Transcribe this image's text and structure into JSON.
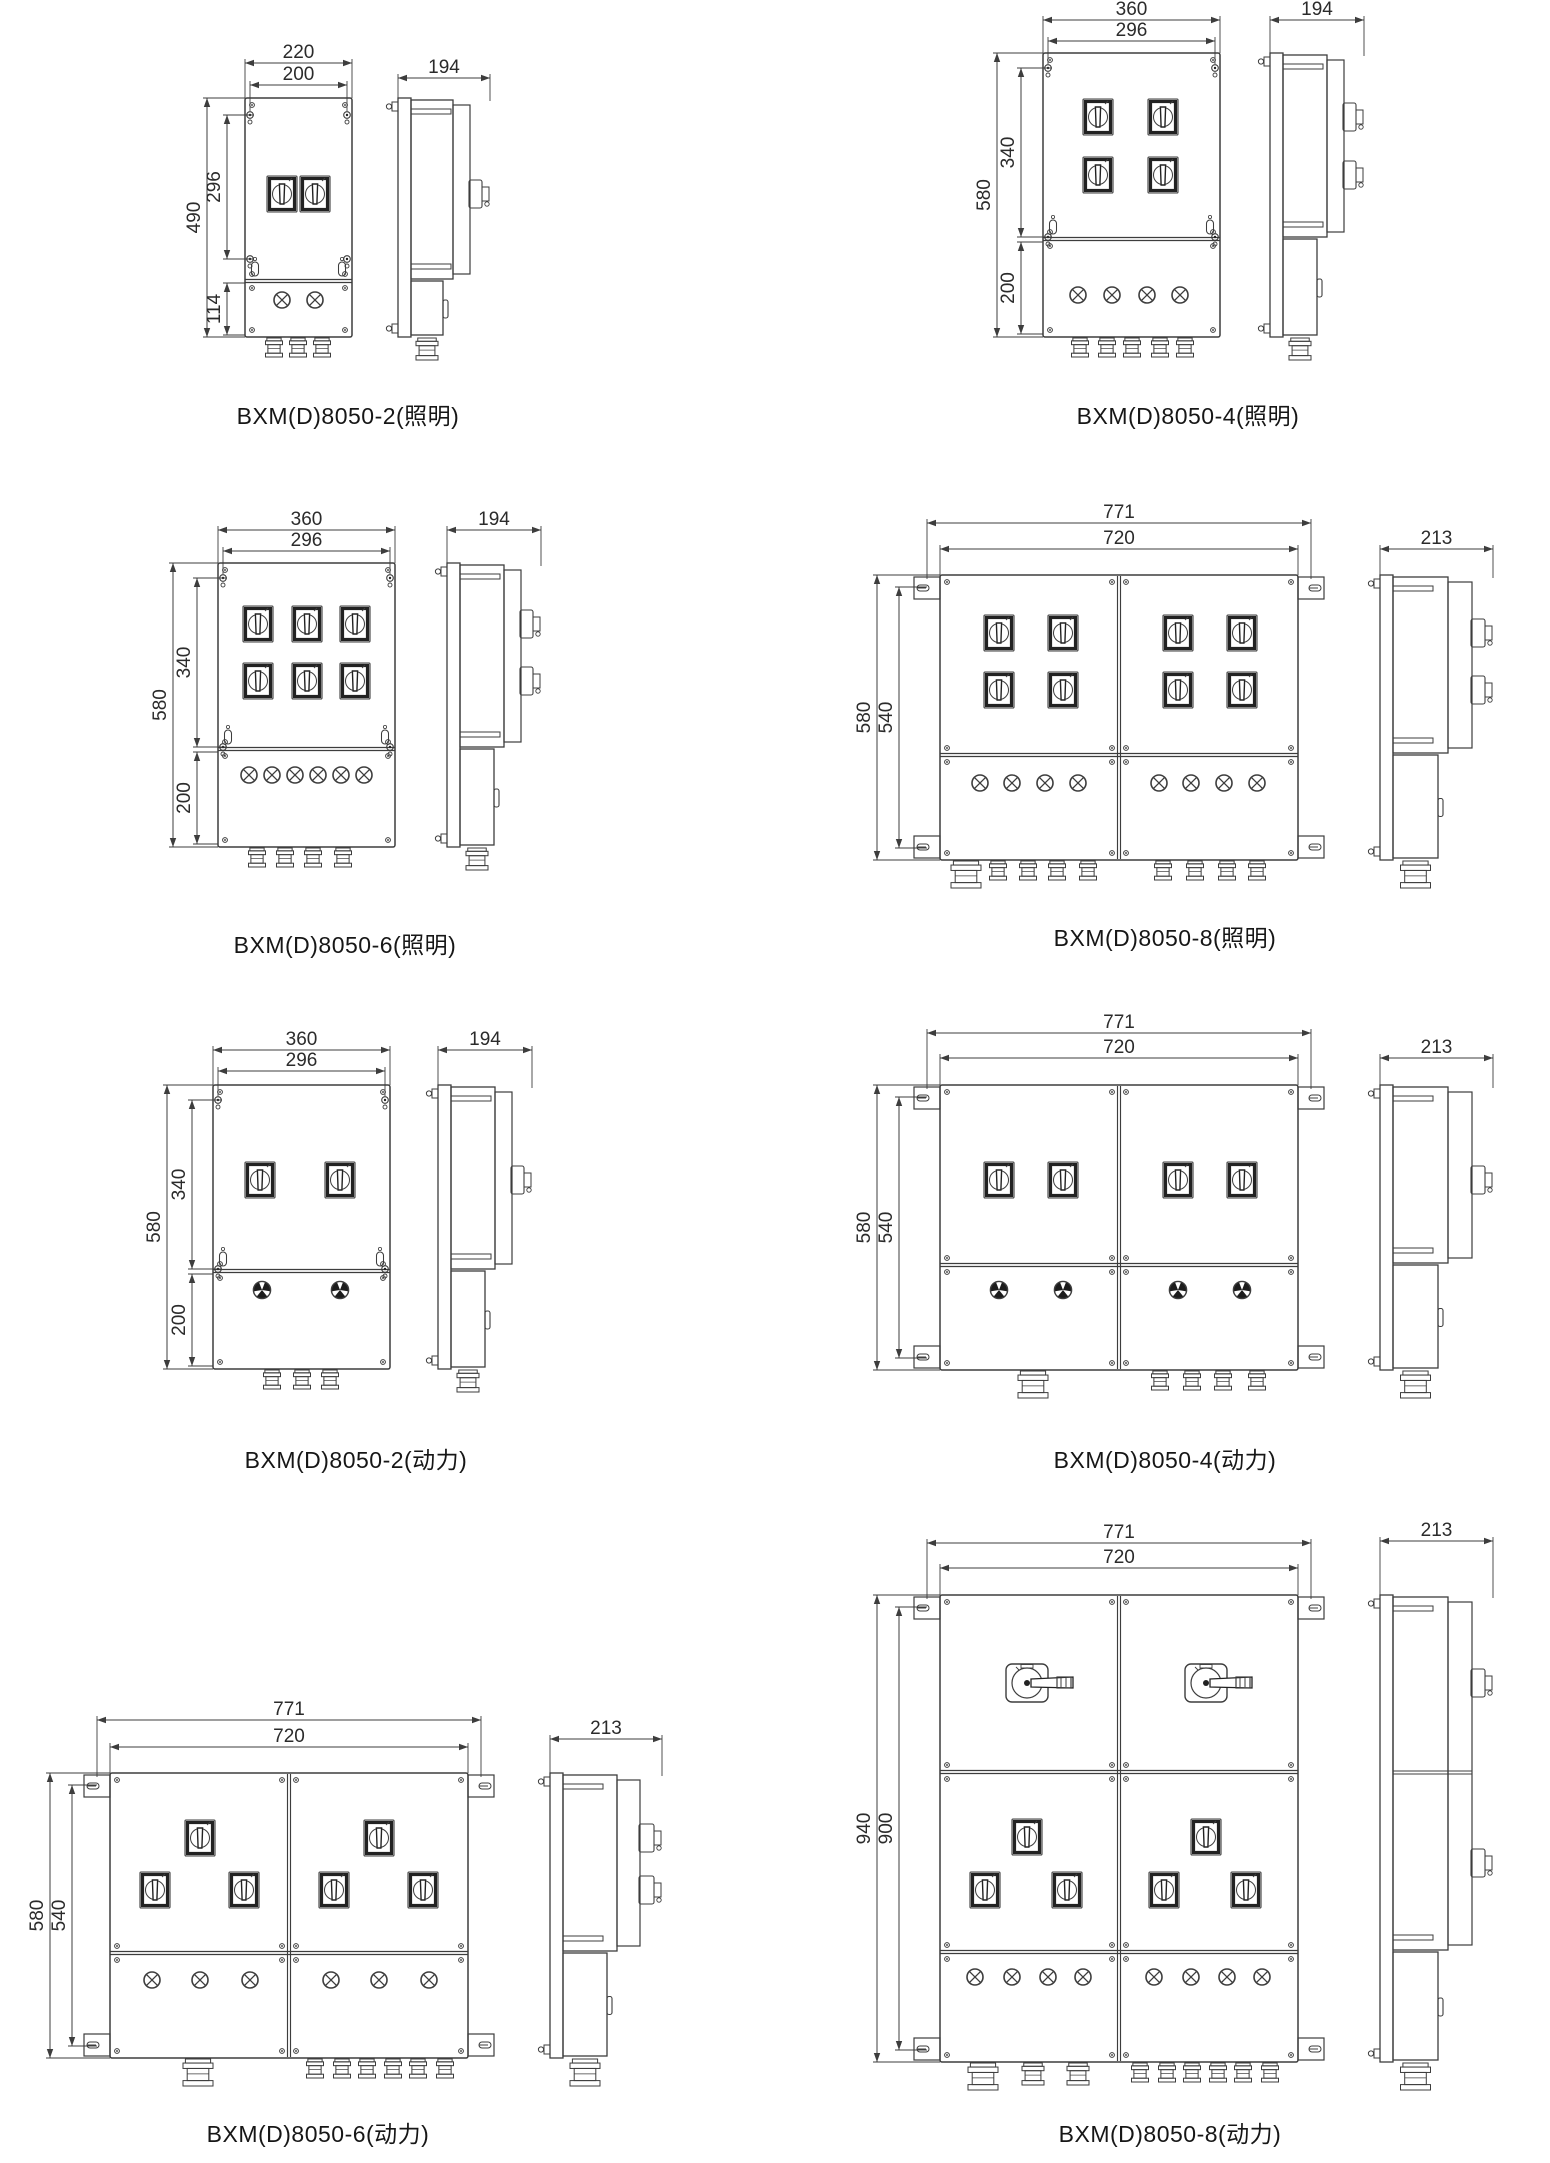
{
  "sheet": {
    "bg": "#ffffff",
    "ink": "#3d3d3d",
    "dark": "#222222",
    "text": "#2b2b2b",
    "product_series": "BXM(D)8050"
  },
  "figures": [
    {
      "id": "f1",
      "caption": "BXM(D)8050-2(照明)",
      "dims": {
        "top_outer": "220",
        "top_inner": "200",
        "left_outer": "490",
        "left_inner": "296",
        "left_lower": "114",
        "side": "194"
      },
      "components": {
        "panels": 1,
        "switches": 2,
        "indicator_type": "lamp",
        "indicators": 2,
        "glands_front": 3,
        "glands_side": 1
      }
    },
    {
      "id": "f2",
      "caption": "BXM(D)8050-4(照明)",
      "dims": {
        "top_outer": "360",
        "top_inner": "296",
        "left_outer": "580",
        "left_inner": "340",
        "left_lower": "200",
        "side": "194"
      },
      "components": {
        "panels": 1,
        "switches": 4,
        "indicator_type": "lamp",
        "indicators": 4,
        "glands_front": 5,
        "glands_side": 1
      }
    },
    {
      "id": "f3",
      "caption": "BXM(D)8050-6(照明)",
      "dims": {
        "top_outer": "360",
        "top_inner": "296",
        "left_outer": "580",
        "left_inner": "340",
        "left_lower": "200",
        "side": "194"
      },
      "components": {
        "panels": 1,
        "switches": 6,
        "indicator_type": "lamp",
        "indicators": 6,
        "glands_front": 4,
        "glands_side": 2
      }
    },
    {
      "id": "f4",
      "caption": "BXM(D)8050-8(照明)",
      "dims": {
        "top_outer": "771",
        "top_inner": "720",
        "left_outer": "580",
        "left_inner": "540",
        "side": "213"
      },
      "components": {
        "panels": 2,
        "switches": 8,
        "indicator_type": "lamp",
        "indicators": 8,
        "glands_front": 9,
        "glands_side": 1
      }
    },
    {
      "id": "f5",
      "caption": "BXM(D)8050-2(动力)",
      "dims": {
        "top_outer": "360",
        "top_inner": "296",
        "left_outer": "580",
        "left_inner": "340",
        "left_lower": "200",
        "side": "194"
      },
      "components": {
        "panels": 1,
        "switches": 2,
        "indicator_type": "power-button",
        "indicators": 2,
        "glands_front": 3,
        "glands_side": 1
      }
    },
    {
      "id": "f6",
      "caption": "BXM(D)8050-4(动力)",
      "dims": {
        "top_outer": "771",
        "top_inner": "720",
        "left_outer": "580",
        "left_inner": "540",
        "side": "213"
      },
      "components": {
        "panels": 2,
        "switches": 4,
        "indicator_type": "power-button",
        "indicators": 4,
        "glands_front": 5,
        "glands_side": 1
      }
    },
    {
      "id": "f7",
      "caption": "BXM(D)8050-6(动力)",
      "dims": {
        "top_outer": "771",
        "top_inner": "720",
        "left_outer": "580",
        "left_inner": "540",
        "side": "213"
      },
      "components": {
        "panels": 2,
        "switches": 6,
        "indicator_type": "lamp",
        "indicators": 6,
        "glands_front": 7,
        "glands_side": 1
      }
    },
    {
      "id": "f8",
      "caption": "BXM(D)8050-8(动力)",
      "dims": {
        "top_outer": "771",
        "top_inner": "720",
        "left_outer": "940",
        "left_inner": "900",
        "side": "213"
      },
      "components": {
        "panels": 2,
        "main_switches": 2,
        "switches": 6,
        "indicator_type": "lamp",
        "indicators": 8,
        "glands_front": 9,
        "glands_side": 1
      }
    }
  ]
}
